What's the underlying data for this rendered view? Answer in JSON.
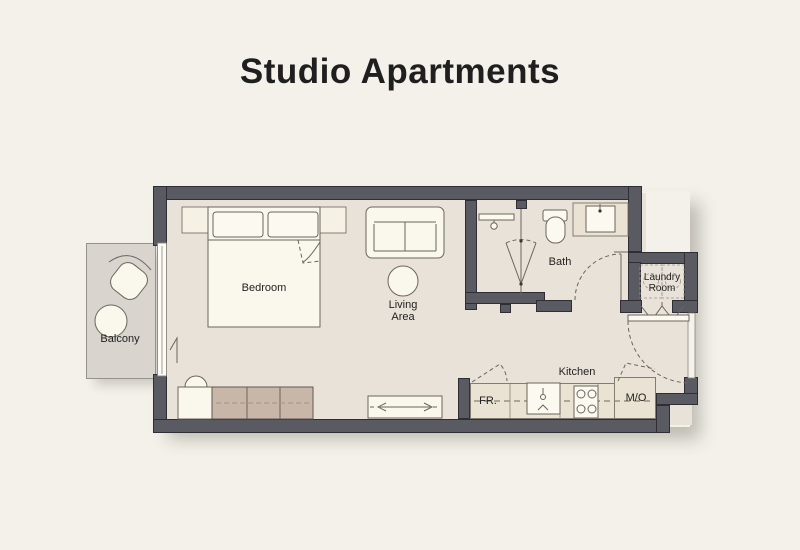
{
  "title": "Studio Apartments",
  "colors": {
    "background": "#f3f1ea",
    "wall": "#5a5a62",
    "wall_outline": "#2e2e34",
    "floor": "#e9e2d8",
    "balcony_floor": "#d9d5ce",
    "furniture_light": "#faf7ec",
    "furniture_taupe": "#c8b6a9",
    "counter": "#eae2d2",
    "line": "#6b655c",
    "text": "#1f1f1f"
  },
  "rooms": {
    "bedroom": {
      "label": "Bedroom"
    },
    "living_area": {
      "line1": "Living",
      "line2": "Area"
    },
    "bath": {
      "label": "Bath"
    },
    "laundry_room": {
      "line1": "Laundry",
      "line2": "Room"
    },
    "kitchen": {
      "label": "Kitchen"
    },
    "balcony": {
      "label": "Balcony"
    }
  },
  "appliances": {
    "fridge": "FR.",
    "micro_oven": "M/O"
  }
}
